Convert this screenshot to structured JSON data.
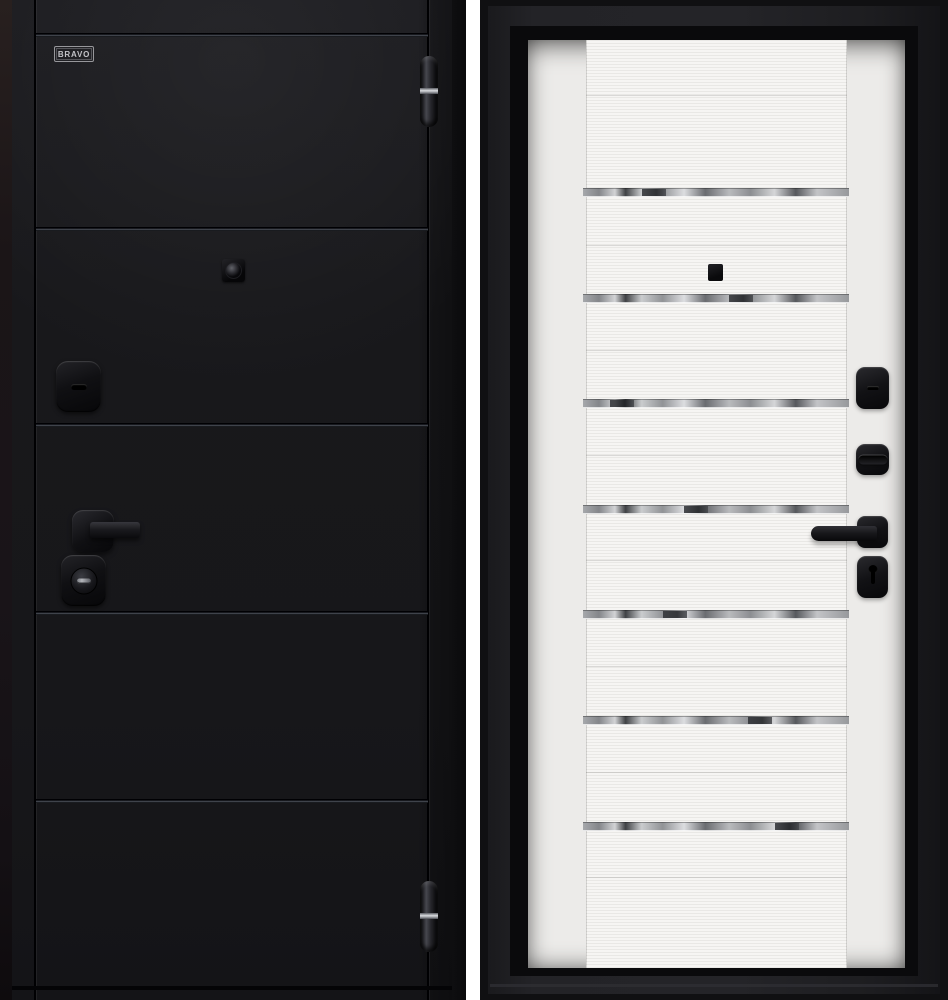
{
  "page": {
    "type": "product photo",
    "subject": "steel entry door shown from both sides",
    "background": "#ffffff"
  },
  "brand": {
    "label": "BRAVO"
  },
  "exterior_view": {
    "side": "exterior",
    "finish_color": "#17171a",
    "panel_grooves": 4,
    "hardware": [
      "brand-logo",
      "door-hinge-top",
      "door-hinge-bottom",
      "peephole-viewer",
      "upper-lock-escutcheon",
      "lever-handle",
      "lock-cylinder-escutcheon"
    ]
  },
  "interior_view": {
    "side": "interior",
    "finish_color": "#f6f5f3",
    "glass_insert_strips": 7,
    "hardware": [
      "peephole-viewer",
      "upper-lock-escutcheon",
      "deadbolt-thumbturn",
      "lever-handle",
      "keyhole-escutcheon"
    ]
  },
  "colors": {
    "leaf_black": "#17171a",
    "frame_black": "#232327",
    "leaf_white": "#f6f5f3",
    "hinge_band_silver": "#d9dbdf",
    "glass_gray": "#a6a8ab"
  }
}
